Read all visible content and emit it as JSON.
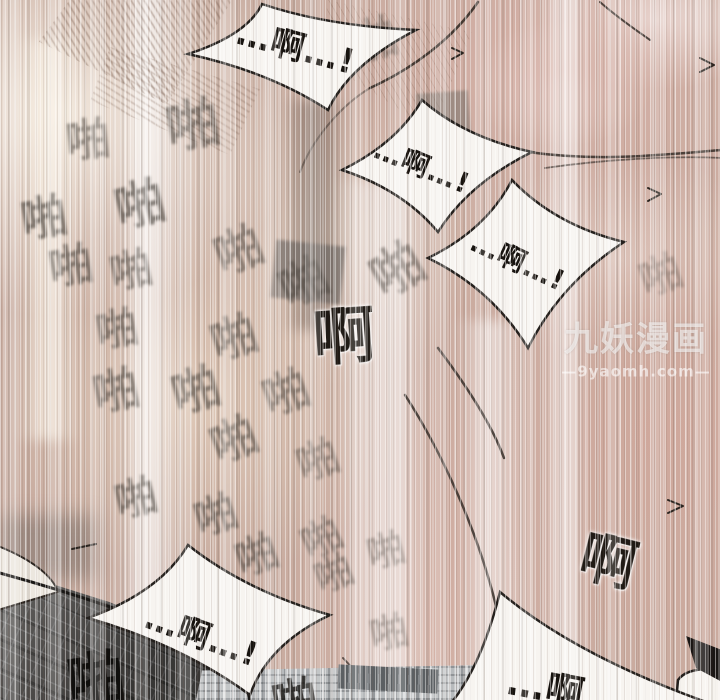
{
  "canvas": {
    "width": 720,
    "height": 700
  },
  "bubbles": [
    {
      "id": "top-center",
      "text": "…啊…!"
    },
    {
      "id": "upper-right",
      "text": "…啊…!"
    },
    {
      "id": "mid-right",
      "text": "…啊…!"
    },
    {
      "id": "bottom-center",
      "text": "…啊…!"
    },
    {
      "id": "bottom-right",
      "text": "…啊"
    }
  ],
  "sfx": {
    "slap_char": "啪",
    "moan_char": "啊",
    "items": [
      {
        "char": "啪",
        "x": 88,
        "y": 141,
        "s": 44,
        "r": -6,
        "o": 0.5
      },
      {
        "char": "啪",
        "x": 193,
        "y": 126,
        "s": 54,
        "r": -10,
        "o": 0.55
      },
      {
        "char": "啪",
        "x": 140,
        "y": 205,
        "s": 50,
        "r": -14,
        "o": 0.6
      },
      {
        "char": "啪",
        "x": 44,
        "y": 218,
        "s": 46,
        "r": -10,
        "o": 0.62
      },
      {
        "char": "啪",
        "x": 71,
        "y": 267,
        "s": 44,
        "r": -10,
        "o": 0.58
      },
      {
        "char": "啪",
        "x": 131,
        "y": 271,
        "s": 42,
        "r": -12,
        "o": 0.52
      },
      {
        "char": "啪",
        "x": 239,
        "y": 251,
        "s": 48,
        "r": -22,
        "o": 0.5
      },
      {
        "char": "啪",
        "x": 304,
        "y": 283,
        "s": 48,
        "r": -26,
        "o": 0.46
      },
      {
        "char": "啪",
        "x": 117,
        "y": 330,
        "s": 42,
        "r": -10,
        "o": 0.56
      },
      {
        "char": "啪",
        "x": 234,
        "y": 338,
        "s": 46,
        "r": -18,
        "o": 0.54
      },
      {
        "char": "啪",
        "x": 398,
        "y": 271,
        "s": 52,
        "r": -30,
        "o": 0.46
      },
      {
        "char": "啪",
        "x": 374,
        "y": 40,
        "s": 46,
        "r": -15,
        "o": 0.4
      },
      {
        "char": "啪",
        "x": 116,
        "y": 391,
        "s": 46,
        "r": -12,
        "o": 0.56
      },
      {
        "char": "啪",
        "x": 196,
        "y": 391,
        "s": 48,
        "r": -16,
        "o": 0.56
      },
      {
        "char": "啪",
        "x": 286,
        "y": 393,
        "s": 46,
        "r": -20,
        "o": 0.5
      },
      {
        "char": "啪",
        "x": 234,
        "y": 440,
        "s": 46,
        "r": -22,
        "o": 0.54
      },
      {
        "char": "啪",
        "x": 318,
        "y": 461,
        "s": 42,
        "r": -20,
        "o": 0.42
      },
      {
        "char": "啪",
        "x": 136,
        "y": 499,
        "s": 42,
        "r": -14,
        "o": 0.56
      },
      {
        "char": "啪",
        "x": 216,
        "y": 516,
        "s": 42,
        "r": -18,
        "o": 0.56
      },
      {
        "char": "啪",
        "x": 257,
        "y": 556,
        "s": 42,
        "r": -20,
        "o": 0.55
      },
      {
        "char": "啪",
        "x": 322,
        "y": 539,
        "s": 40,
        "r": -26,
        "o": 0.45
      },
      {
        "char": "啪",
        "x": 334,
        "y": 574,
        "s": 38,
        "r": -22,
        "o": 0.45
      },
      {
        "char": "啪",
        "x": 661,
        "y": 276,
        "s": 42,
        "r": -20,
        "o": 0.3
      },
      {
        "char": "啪",
        "x": 386,
        "y": 551,
        "s": 38,
        "r": -15,
        "o": 0.34
      },
      {
        "char": "啪",
        "x": 389,
        "y": 633,
        "s": 38,
        "r": -12,
        "o": 0.34
      },
      {
        "char": "啊",
        "x": 344,
        "y": 337,
        "s": 62,
        "r": -4,
        "o": 0.95,
        "c": "#17130e",
        "b": 0.2,
        "halo": true
      },
      {
        "char": "啊",
        "x": 608,
        "y": 563,
        "s": 56,
        "r": 14,
        "o": 0.95,
        "c": "#17130e",
        "b": 0.2,
        "halo": true
      },
      {
        "char": "啪",
        "x": 96,
        "y": 680,
        "s": 58,
        "r": -8,
        "o": 0.95,
        "c": "#0e0d0b",
        "b": 0.2,
        "layer": "over"
      },
      {
        "char": "啪",
        "x": 295,
        "y": 701,
        "s": 46,
        "r": -10,
        "o": 0.8,
        "c": "#14120f",
        "b": 0.3,
        "layer": "over"
      }
    ]
  },
  "watermark": {
    "brand": "九妖漫画",
    "site": "—9yaomh.com—"
  },
  "colors": {
    "skin": "#c8aca0",
    "bubble_fill": "#f7f4f0",
    "ink": "#221e1a",
    "sfx_grey": "#403b35",
    "fabric_dark": "#4e4c4a",
    "fabric_light": "#b7babc",
    "watermark": "#ffffff"
  }
}
